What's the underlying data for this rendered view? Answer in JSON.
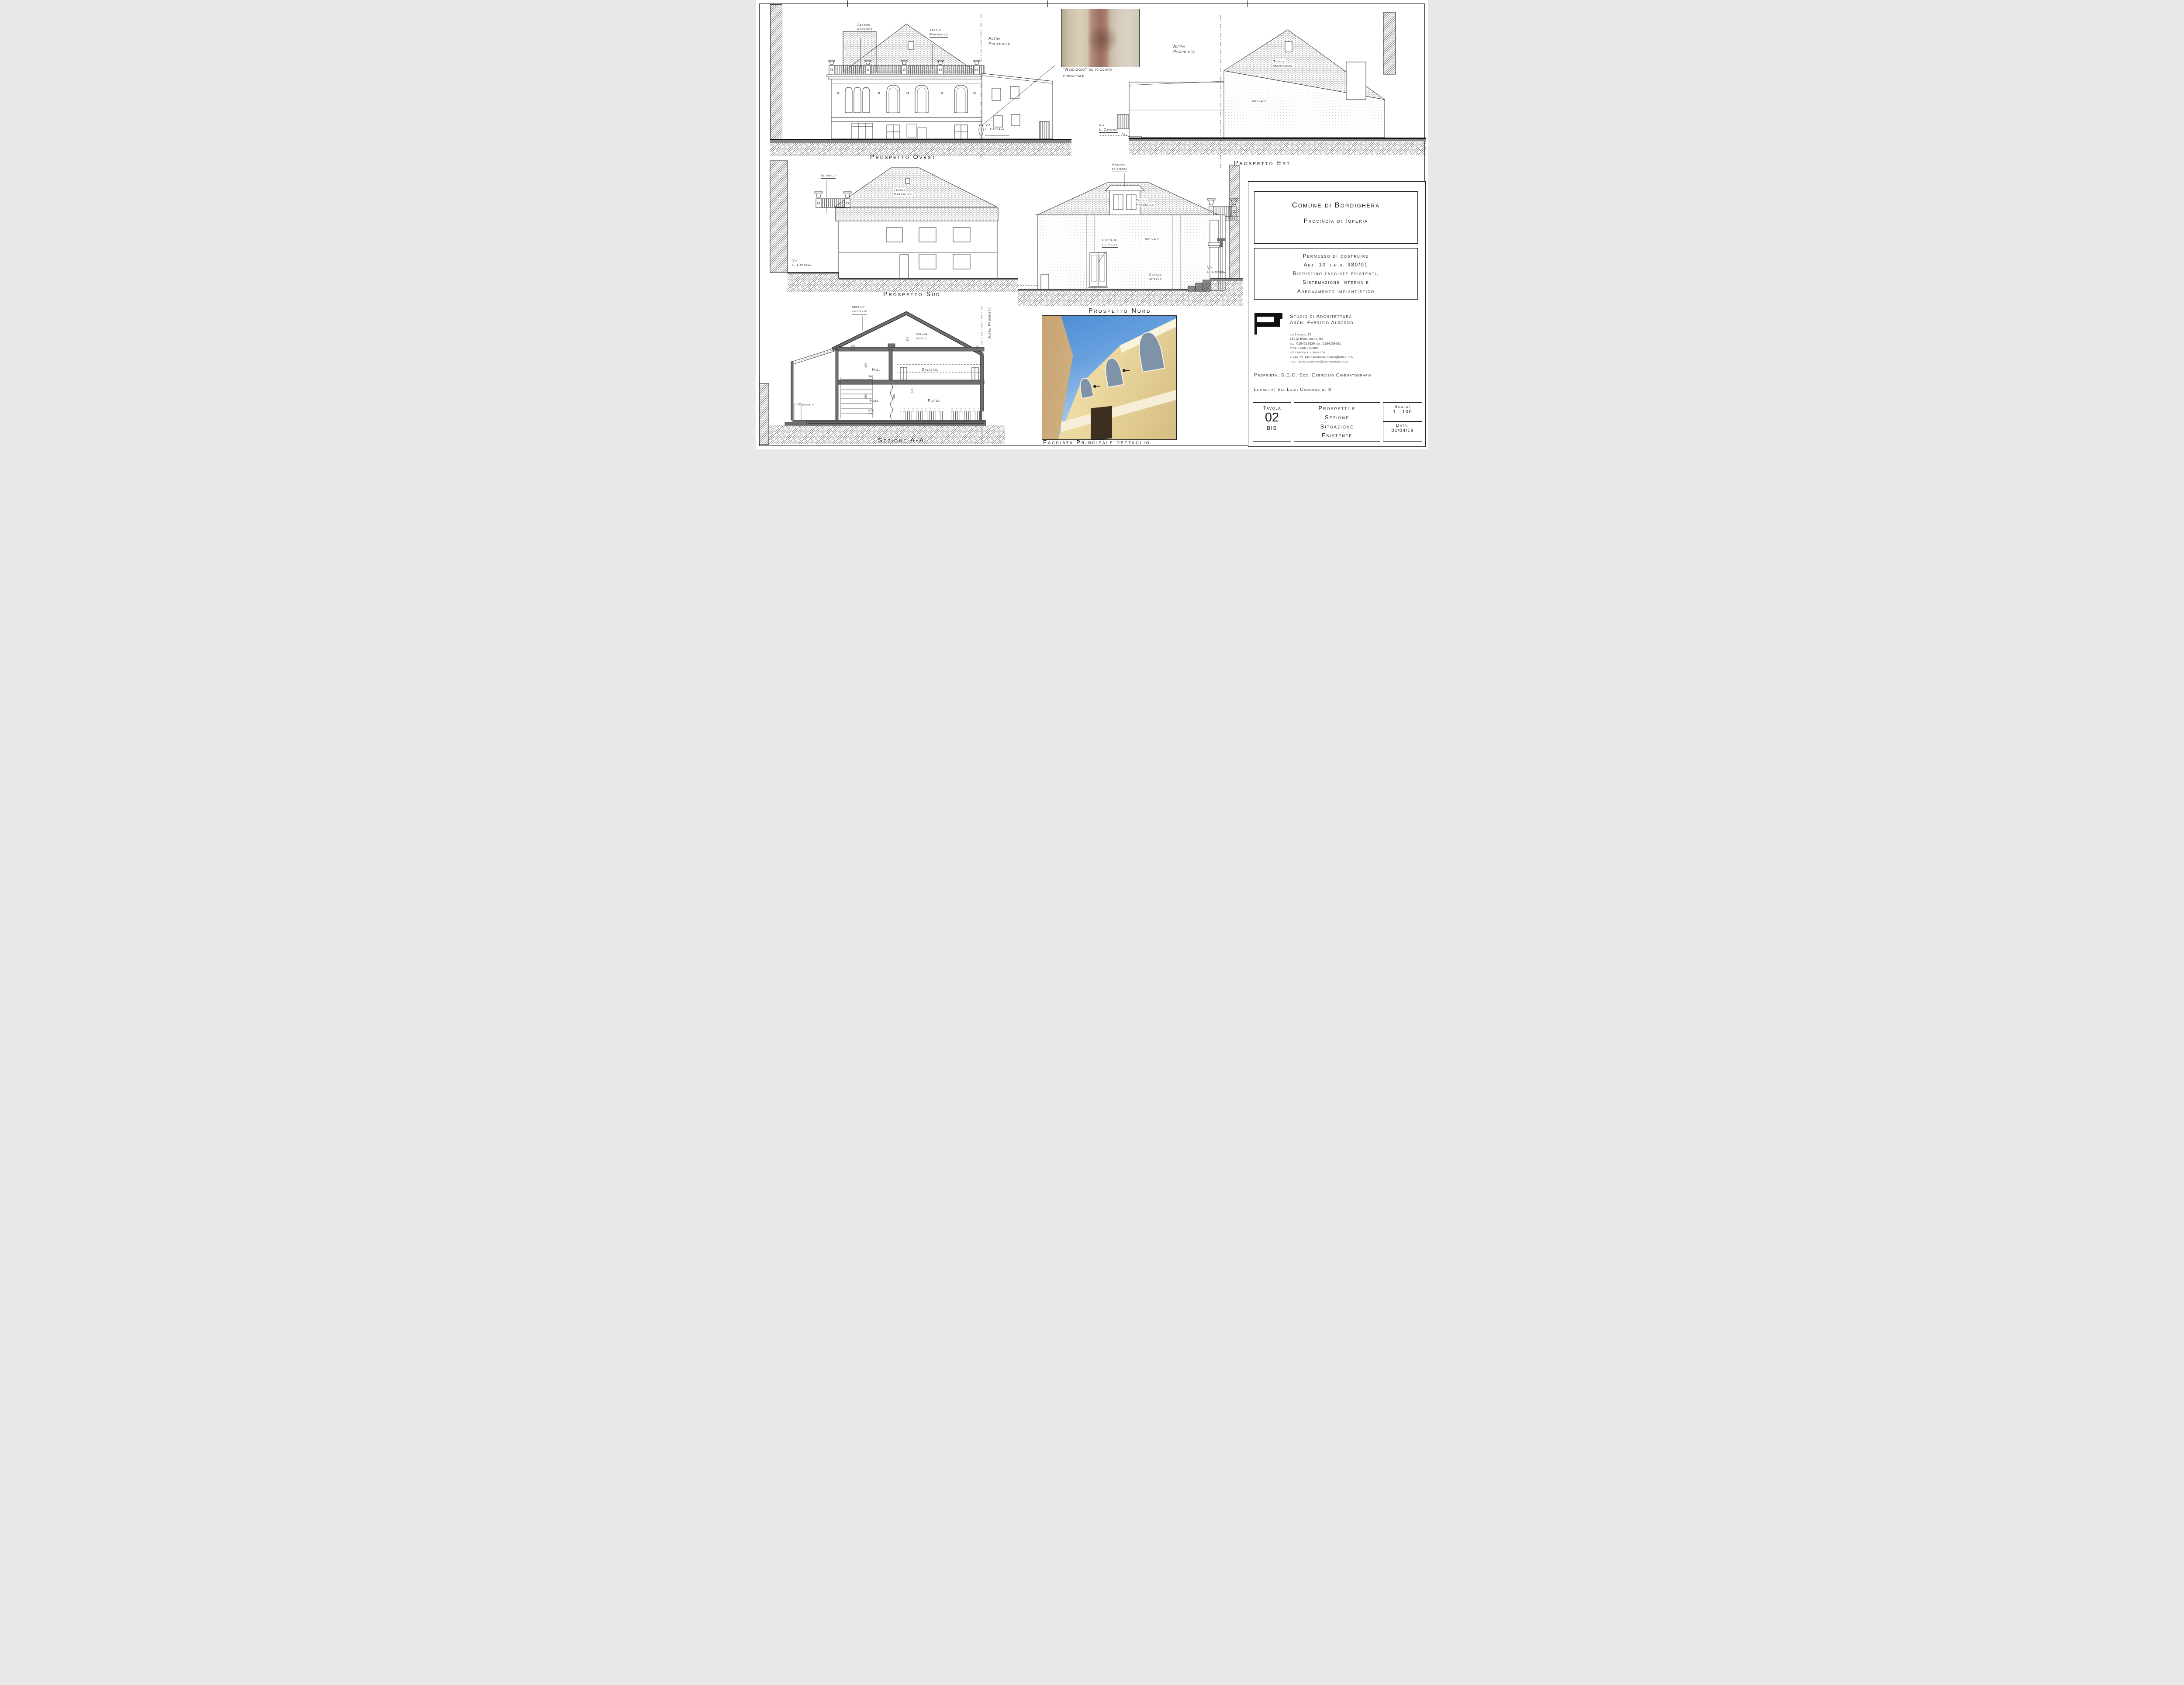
{
  "ovest": {
    "caption": "Prospetto Ovest",
    "abbaino": [
      "Abbaino",
      "esistente"
    ],
    "tegole": [
      "Tegole",
      "Marsigliesi"
    ],
    "altra": [
      "Altra",
      "Proprietà"
    ],
    "via": [
      "Via",
      "L. Cadorna"
    ]
  },
  "assaggio": {
    "caption": [
      "\"Assaggio\" su facciata",
      "principale"
    ]
  },
  "est": {
    "caption": "Prospetto Est",
    "altra": [
      "Altra",
      "Proprietà"
    ],
    "tegole": [
      "Tegole",
      "Marsigliesi"
    ],
    "intonaco": "Intonaco",
    "via": [
      "Via",
      "L. Cadorna"
    ]
  },
  "sud": {
    "caption": "Prospetto Sud",
    "intonaco": "Intonaco",
    "tegole": [
      "Tegole",
      "Marsigliesi"
    ],
    "via": [
      "Via",
      "L. Cadorna"
    ]
  },
  "nord": {
    "caption": "Prospetto Nord",
    "abbaino": [
      "Abbaino",
      "esistente"
    ],
    "tegole": [
      "Tegole",
      "Marsigliesi"
    ],
    "uscita": [
      "Uscita di",
      "sicurezza"
    ],
    "intonaco": "Intonaco",
    "cortile": [
      "Cortile",
      "Interno"
    ],
    "via": [
      "Via",
      "L. Cadorna"
    ]
  },
  "sezione": {
    "caption": "Sezione A-A",
    "abbaino": [
      "Abbaino",
      "esistente"
    ],
    "volume": [
      "Volume",
      "tecnico"
    ],
    "altra": "Altra Proprietà",
    "hall_up": "Hall",
    "galleria": "Galleria",
    "hall_low": "Hall",
    "platea": "Platea",
    "cortile": "Cortile",
    "dims": {
      "d690": "690",
      "d370": "370",
      "d300": "300",
      "d360": "360",
      "d330": "330",
      "d340": "340",
      "d600": "600",
      "d000": "0.00",
      "d50": "50"
    }
  },
  "foto": {
    "caption": "Facciata Principale dettaglio"
  },
  "title_block": {
    "comune": "Comune di Bordighera",
    "provincia": "Provincia di Imperia",
    "permesso": [
      "Permesso di costruire",
      "Art. 10 d.p.r. 380/01",
      "Ripristino facciate esistenti,",
      "Sistemazione interna e",
      "Adeguamento impiantistico"
    ],
    "studio": [
      "Studio di Architettura",
      "Arch. Fabrizio Alborno"
    ],
    "address": [
      "via Lagazzi, 10",
      "18012 Bordighera, IM",
      "tel: 0184262529 fax: 0184268661",
      "P.iva 01401970080",
      "http://www.alborno.com",
      "e-mail to: arch.fabrizioalborno@gmail.com",
      "pec: fabrizioalborno@archiworldpec.it"
    ],
    "proprieta": "Proprietà: S.E.C. Soc. Esercizio Cinematografia",
    "localita": "Località: Via Luigi Cadorna n. 3",
    "tavola_label": "Tavola",
    "tavola_num": "02",
    "tavola_bis": "BIS",
    "titolo": [
      "Prospetti e",
      "Sezione",
      "Situazione",
      "Esistente"
    ],
    "scala_label": "Scala:",
    "scala_value": "1 : 100",
    "data_label": "Data:",
    "data_value": "01/04/19"
  },
  "colors": {
    "ink": "#222222",
    "section_gray": "#6e6e6e",
    "ground_gray": "#8a8a8a",
    "sky": "#4c8bd4",
    "facade_cream": "#ecd9a0",
    "plaster_red": "#9c6f62"
  }
}
